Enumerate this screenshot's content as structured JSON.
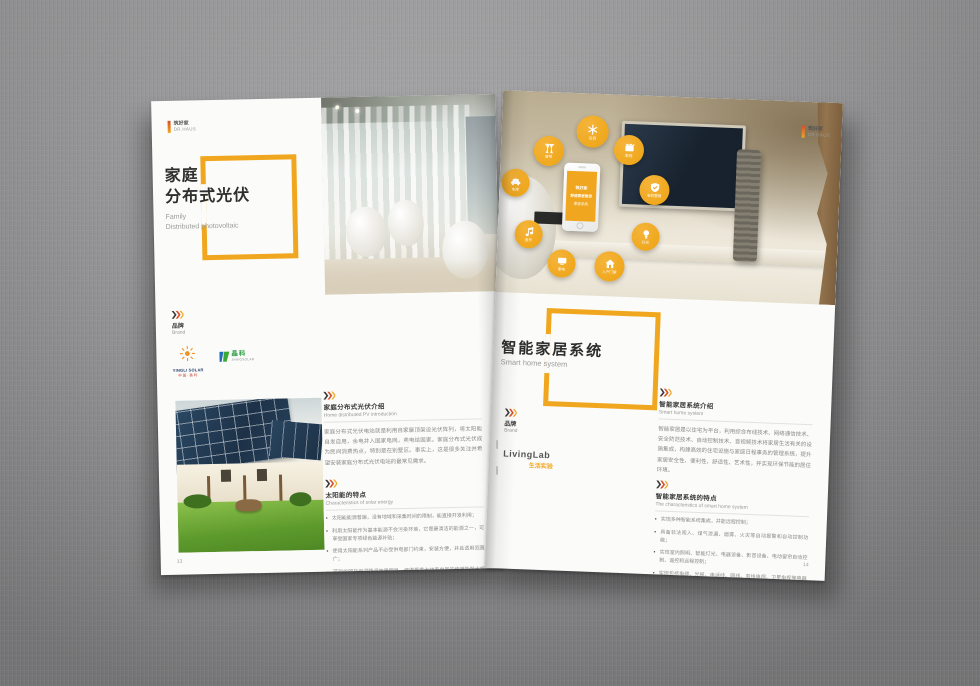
{
  "accent": "#f0a71f",
  "left_page": {
    "logo": {
      "zh": "筑好家",
      "en": "DR.HAUS"
    },
    "title": {
      "zh1": "家庭",
      "zh2": "分布式光伏",
      "en1": "Family",
      "en2": "Distributed photovoltaic"
    },
    "brand": {
      "zh": "品牌",
      "en": "Brand",
      "yingli": {
        "name": "YINGLI SOLAR",
        "sub": "中国·英利"
      },
      "jinko": {
        "name": "晶科",
        "sub": "JINKOSOLAR"
      }
    },
    "intro": {
      "zh": "家庭分布式光伏介绍",
      "en": "Home distributed PV introduction",
      "body": "家庭分布式光伏电站就是利用自家屋顶架设光伏阵列，将太阳能自发自用，余电并入国家电网，卖电给国家。家庭分布式光伏成为民间消费热点，特别是在别墅区。事实上，这是很多关注并希望安装家庭分布式光伏电站的最常见需求。"
    },
    "solar": {
      "zh": "太阳能的特点",
      "en": "Characteristics of solar energy",
      "bullets": [
        "太阳能能源普遍，没有地域和采集时间的限制，能直接开发利用；",
        "利用太阳能作为基本能源不会污染环境，它是最清洁的能源之一，可享受国家专项绿色能源补贴；",
        "使用太阳能系列产品不必受供电部门约束，安装方便，并且适用范围广；",
        "可观的隔热保温降温效果明显，使得夏季大功率电器的使用能耗大幅减少。"
      ]
    },
    "page_number": "13"
  },
  "right_page": {
    "logo": {
      "zh": "筑好家",
      "en": "DR.HAUS"
    },
    "title": {
      "zh": "智能家居系统",
      "en": "Smart home system"
    },
    "phone": {
      "brand": "筑好家",
      "line1": "舒适家居智控",
      "line2": "家居系统"
    },
    "icons": [
      {
        "label": "窗帘"
      },
      {
        "label": "空调"
      },
      {
        "label": "影视"
      },
      {
        "label": "车库"
      },
      {
        "label": "安防警报"
      },
      {
        "label": "音乐"
      },
      {
        "label": "灯光"
      },
      {
        "label": "家电"
      },
      {
        "label": "入户门禁"
      }
    ],
    "brand": {
      "zh": "品牌",
      "en": "Brand",
      "logo": "LivingLab",
      "logo_sub": "生活实验"
    },
    "intro": {
      "zh": "智能家居系统介绍",
      "en": "Smart home system",
      "body": "智能家居是以住宅为平台，利用综合布线技术、网络通信技术、安全防范技术、自动控制技术、音视频技术将家居生活有关的设施集成，构建高效的住宅设施与家庭日程事务的管理系统，提升家居安全性、便利性、舒适性、艺术性，并实现环保节能的居住环境。"
    },
    "features": {
      "zh": "智能家居系统的特点",
      "en": "The characteristics of smart home system",
      "bullets": [
        "实现多种智能系统集成，并能远程控制；",
        "具备非法闯入、煤气泄漏、烟雾、火灾等自动报警和自动控制功能；",
        "实现室内照明、智能灯光、电器设备、影音设备、电动窗帘自动控制、遥控和远程控制；",
        "实现包括电缆、光缆、电话线、网线、有线电视、卫星电视等电器的综合布线和集中管理，并为后续装修预留空间。"
      ]
    },
    "page_number": "14"
  }
}
